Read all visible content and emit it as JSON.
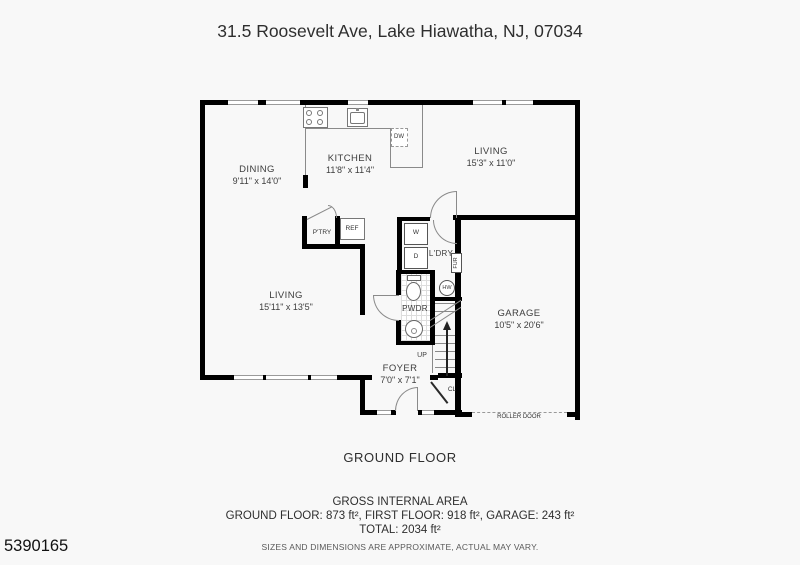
{
  "page": {
    "title": "31.5 Roosevelt Ave, Lake Hiawatha, NJ, 07034",
    "floor_label": "GROUND FLOOR",
    "footer": {
      "heading": "GROSS INTERNAL AREA",
      "areas_line": "GROUND FLOOR: 873 ft², FIRST FLOOR: 918 ft², GARAGE: 243 ft²",
      "total_line": "TOTAL: 2034 ft²",
      "disclaimer": "SIZES AND DIMENSIONS ARE APPROXIMATE, ACTUAL MAY VARY.",
      "listing_id": "5390165"
    }
  },
  "floorplan": {
    "rooms": {
      "dining": {
        "name": "DINING",
        "dims": "9'11\" x 14'0\""
      },
      "kitchen": {
        "name": "KITCHEN",
        "dims": "11'8\" x 11'4\""
      },
      "living_upper": {
        "name": "LIVING",
        "dims": "15'3\" x 11'0\""
      },
      "living_main": {
        "name": "LIVING",
        "dims": "15'11\" x 13'5\""
      },
      "garage": {
        "name": "GARAGE",
        "dims": "10'5\" x 20'6\""
      },
      "foyer": {
        "name": "FOYER",
        "dims": "7'0\" x 7'1\""
      }
    },
    "fixtures": {
      "pantry": "P'TRY",
      "fridge": "REF",
      "dishwasher": "DW",
      "washer": "W",
      "dryer": "D",
      "laundry": "L'DRY",
      "furnace": "FUR",
      "water_heater": "HW",
      "powder_room": "PWDR",
      "closet": "CL",
      "stairs_up": "UP",
      "roller_door": "ROLLER DOOR"
    },
    "colors": {
      "wall": "#000000",
      "fixture_line": "#8a8a8a",
      "label_text": "#3d3d3d"
    }
  }
}
